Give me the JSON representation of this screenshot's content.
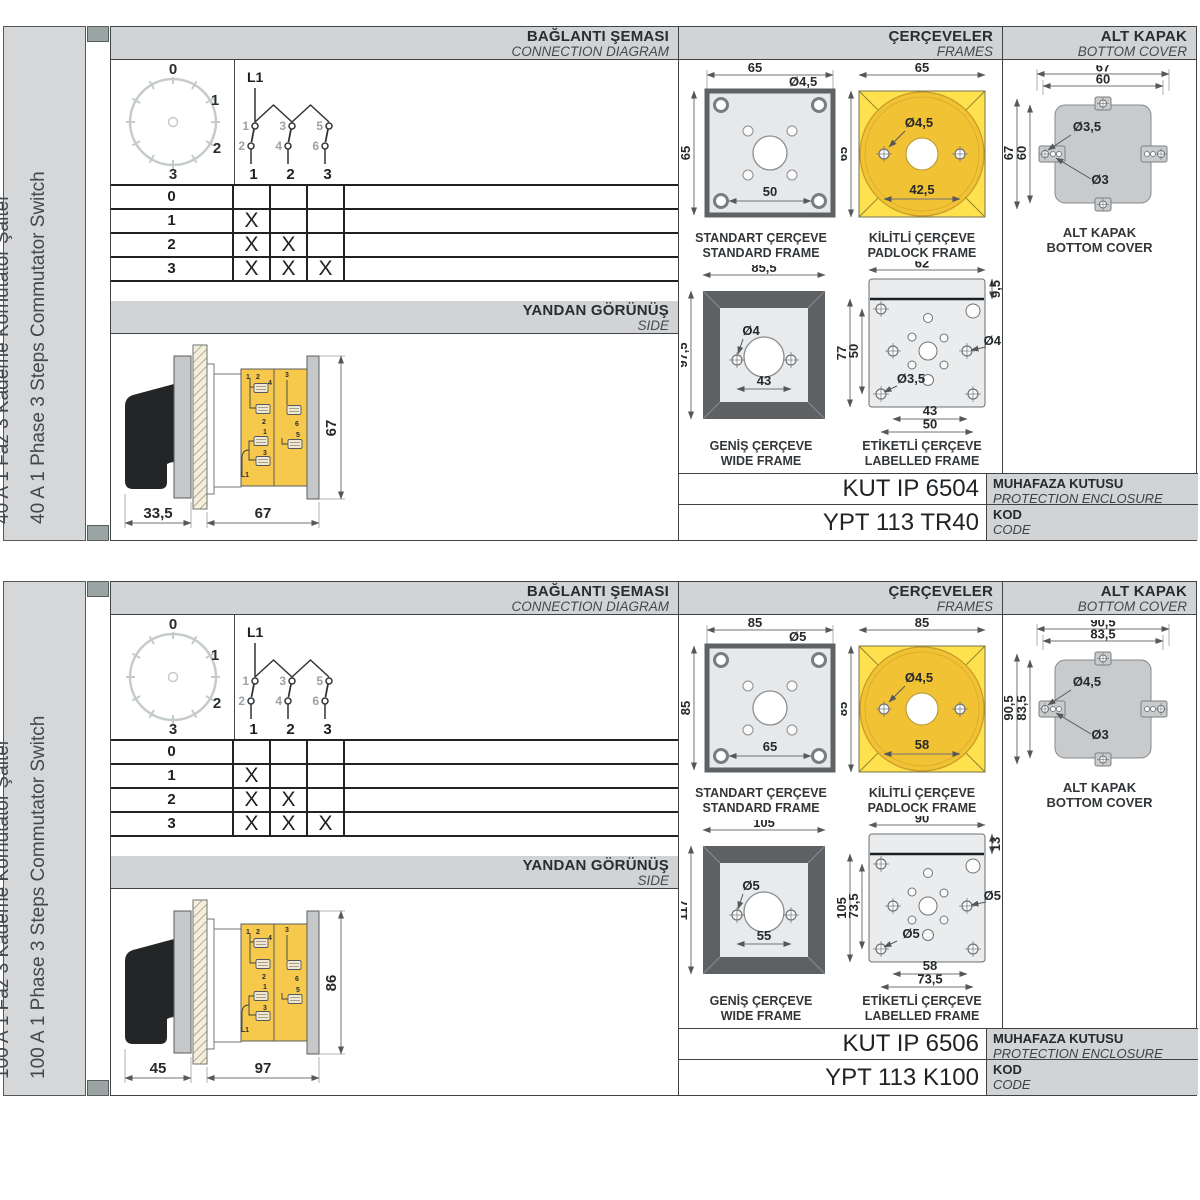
{
  "panels": [
    {
      "sidebar": {
        "label_tr": "40 A 1 Faz 3 Kademe Komütatör Şalter",
        "label_en": "40 A 1 Phase 3 Steps Commutator Switch"
      },
      "connection": {
        "title_tr": "BAĞLANTI ŞEMASI",
        "title_en": "CONNECTION DIAGRAM",
        "dial": [
          "0",
          "1",
          "2",
          "3"
        ],
        "circuit": {
          "feed": "L1",
          "top": [
            "1",
            "3",
            "5"
          ],
          "bottom": [
            "2",
            "4",
            "6"
          ],
          "columns": [
            "1",
            "2",
            "3"
          ]
        },
        "table": {
          "rows": [
            {
              "label": "0",
              "marks": [
                "",
                "",
                ""
              ]
            },
            {
              "label": "1",
              "marks": [
                "X",
                "",
                ""
              ]
            },
            {
              "label": "2",
              "marks": [
                "X",
                "X",
                ""
              ]
            },
            {
              "label": "3",
              "marks": [
                "X",
                "X",
                "X"
              ]
            }
          ]
        }
      },
      "side": {
        "title_tr": "YANDAN GÖRÜNÜŞ",
        "title_en": "SIDE",
        "dim_a": "33,5",
        "dim_b": "67",
        "dim_h": "67",
        "terminals": [
          "1",
          "2",
          "4",
          "3",
          "2",
          "6",
          "1",
          "5",
          "3",
          "L1"
        ]
      },
      "frames": {
        "title_tr": "ÇERÇEVELER",
        "title_en": "FRAMES",
        "standard": {
          "cap_tr": "STANDART ÇERÇEVE",
          "cap_en": "STANDARD FRAME",
          "w": "65",
          "h": "65",
          "hole": "Ø4,5",
          "pitch": "50"
        },
        "padlock": {
          "cap_tr": "KİLİTLİ ÇERÇEVE",
          "cap_en": "PADLOCK FRAME",
          "w": "65",
          "h": "65",
          "hole": "Ø4,5",
          "pitch": "42,5"
        },
        "wide": {
          "cap_tr": "GENİŞ ÇERÇEVE",
          "cap_en": "WIDE FRAME",
          "w": "85,5",
          "h": "97,5",
          "hole": "Ø4",
          "pitch": "43"
        },
        "labelled": {
          "cap_tr": "ETİKETLİ ÇERÇEVE",
          "cap_en": "LABELLED FRAME",
          "w": "62",
          "strip": "9,5",
          "h": "77",
          "ih": "50",
          "hole_r": "Ø4",
          "hole_b": "Ø3,5",
          "p1": "43",
          "p2": "50"
        }
      },
      "cover": {
        "title_tr": "ALT KAPAK",
        "title_en": "BOTTOM COVER",
        "cap_tr": "ALT KAPAK",
        "cap_en": "BOTTOM COVER",
        "wo": "67",
        "wi": "60",
        "ho": "67",
        "hi": "60",
        "hole_big": "Ø3,5",
        "hole_small": "Ø3"
      },
      "enclosure": {
        "value": "KUT IP 6504",
        "label_tr": "MUHAFAZA KUTUSU",
        "label_en": "PROTECTION ENCLOSURE"
      },
      "code": {
        "value": "YPT 113 TR40",
        "label_tr": "KOD",
        "label_en": "CODE"
      }
    },
    {
      "sidebar": {
        "label_tr": "100 A 1 Faz 3 Kademe Komütatör Şalter",
        "label_en": "100 A 1 Phase 3 Steps Commutator Switch"
      },
      "connection": {
        "title_tr": "BAĞLANTI ŞEMASI",
        "title_en": "CONNECTION DIAGRAM",
        "dial": [
          "0",
          "1",
          "2",
          "3"
        ],
        "circuit": {
          "feed": "L1",
          "top": [
            "1",
            "3",
            "5"
          ],
          "bottom": [
            "2",
            "4",
            "6"
          ],
          "columns": [
            "1",
            "2",
            "3"
          ]
        },
        "table": {
          "rows": [
            {
              "label": "0",
              "marks": [
                "",
                "",
                ""
              ]
            },
            {
              "label": "1",
              "marks": [
                "X",
                "",
                ""
              ]
            },
            {
              "label": "2",
              "marks": [
                "X",
                "X",
                ""
              ]
            },
            {
              "label": "3",
              "marks": [
                "X",
                "X",
                "X"
              ]
            }
          ]
        }
      },
      "side": {
        "title_tr": "YANDAN GÖRÜNÜŞ",
        "title_en": "SIDE",
        "dim_a": "45",
        "dim_b": "97",
        "dim_h": "86",
        "terminals": [
          "1",
          "2",
          "4",
          "3",
          "2",
          "6",
          "1",
          "5",
          "3",
          "L1"
        ]
      },
      "frames": {
        "title_tr": "ÇERÇEVELER",
        "title_en": "FRAMES",
        "standard": {
          "cap_tr": "STANDART ÇERÇEVE",
          "cap_en": "STANDARD FRAME",
          "w": "85",
          "h": "85",
          "hole": "Ø5",
          "pitch": "65"
        },
        "padlock": {
          "cap_tr": "KİLİTLİ ÇERÇEVE",
          "cap_en": "PADLOCK FRAME",
          "w": "85",
          "h": "85",
          "hole": "Ø4,5",
          "pitch": "58"
        },
        "wide": {
          "cap_tr": "GENİŞ ÇERÇEVE",
          "cap_en": "WIDE FRAME",
          "w": "105",
          "h": "117",
          "hole": "Ø5",
          "pitch": "55"
        },
        "labelled": {
          "cap_tr": "ETİKETLİ ÇERÇEVE",
          "cap_en": "LABELLED FRAME",
          "w": "90",
          "strip": "13",
          "h": "105",
          "ih": "73,5",
          "hole_r": "Ø5",
          "hole_b": "Ø5",
          "p1": "58",
          "p2": "73,5"
        }
      },
      "cover": {
        "title_tr": "ALT KAPAK",
        "title_en": "BOTTOM COVER",
        "cap_tr": "ALT KAPAK",
        "cap_en": "BOTTOM COVER",
        "wo": "90,5",
        "wi": "83,5",
        "ho": "90,5",
        "hi": "83,5",
        "hole_big": "Ø4,5",
        "hole_small": "Ø3"
      },
      "enclosure": {
        "value": "KUT IP 6506",
        "label_tr": "MUHAFAZA KUTUSU",
        "label_en": "PROTECTION ENCLOSURE"
      },
      "code": {
        "value": "YPT 113 K100",
        "label_tr": "KOD",
        "label_en": "CODE"
      }
    }
  ],
  "colors": {
    "accent_yellow": "#ffe14e",
    "accent_yellow_dark": "#f2c235",
    "band_gray": "#d2d3d5",
    "clip_gray": "#9aa4a2"
  }
}
